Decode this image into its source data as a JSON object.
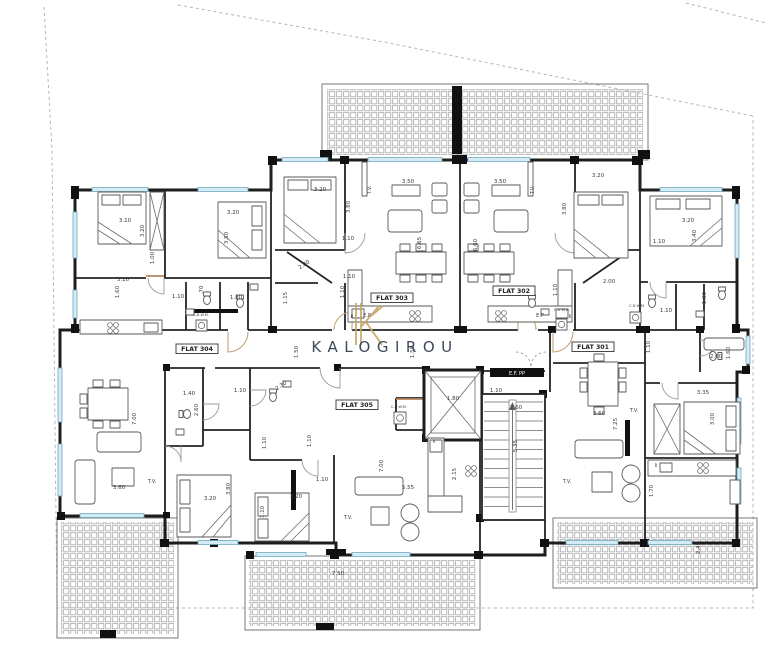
{
  "watermark": {
    "text": "KALOGIROU",
    "color": "#3d4a5c",
    "monogram": "K",
    "monogram_color": "#c5a366"
  },
  "flat_labels": [
    {
      "t": "FLAT 301",
      "x": 593,
      "y": 349
    },
    {
      "t": "FLAT 302",
      "x": 514,
      "y": 293
    },
    {
      "t": "FLAT 303",
      "x": 392,
      "y": 300
    },
    {
      "t": "FLAT 304",
      "x": 197,
      "y": 351
    },
    {
      "t": "FLAT 305",
      "x": 357,
      "y": 407
    }
  ],
  "annotations": [
    {
      "t": "T.V.",
      "x": 371,
      "y": 190,
      "r": -90
    },
    {
      "t": "T.V.",
      "x": 534,
      "y": 190,
      "r": -90
    },
    {
      "t": "T.V.",
      "x": 152,
      "y": 483
    },
    {
      "t": "T.V.",
      "x": 348,
      "y": 519
    },
    {
      "t": "T.V.",
      "x": 567,
      "y": 483
    },
    {
      "t": "T.V.",
      "x": 634,
      "y": 412
    },
    {
      "t": "E.P",
      "x": 367,
      "y": 317
    },
    {
      "t": "E.P",
      "x": 540,
      "y": 317
    },
    {
      "t": "E.F. PP",
      "x": 517,
      "y": 375,
      "s": 5,
      "c": "#ffffff"
    },
    {
      "t": "C.D W.M.",
      "x": 201,
      "y": 316,
      "s": 3.6
    },
    {
      "t": "C.D W.M.",
      "x": 399,
      "y": 408,
      "s": 3.6
    },
    {
      "t": "C.D W.M.",
      "x": 562,
      "y": 311,
      "s": 3.6
    },
    {
      "t": "C.D W.M.",
      "x": 637,
      "y": 307,
      "s": 3.6
    },
    {
      "t": "R",
      "x": 352,
      "y": 318,
      "s": 4
    },
    {
      "t": "R",
      "x": 570,
      "y": 318,
      "s": 4
    },
    {
      "t": "R",
      "x": 434,
      "y": 443,
      "s": 4
    },
    {
      "t": "R",
      "x": 656,
      "y": 467,
      "s": 4
    }
  ],
  "dimensions": [
    {
      "t": "3.10",
      "x": 125,
      "y": 222
    },
    {
      "t": "3.20",
      "x": 144,
      "y": 231,
      "r": -90
    },
    {
      "t": "3.20",
      "x": 233,
      "y": 214
    },
    {
      "t": "3.50",
      "x": 228,
      "y": 238,
      "r": -90
    },
    {
      "t": "1.00",
      "x": 154,
      "y": 258,
      "r": -90
    },
    {
      "t": "3.10",
      "x": 123,
      "y": 281
    },
    {
      "t": "1.60",
      "x": 119,
      "y": 292,
      "r": -90
    },
    {
      "t": "1.10",
      "x": 178,
      "y": 298
    },
    {
      "t": ".70",
      "x": 203,
      "y": 290,
      "r": -90
    },
    {
      "t": "1.80",
      "x": 236,
      "y": 299
    },
    {
      "t": "1.15",
      "x": 287,
      "y": 298,
      "r": -90
    },
    {
      "t": "3.20",
      "x": 320,
      "y": 191
    },
    {
      "t": "3.80",
      "x": 350,
      "y": 207,
      "r": -90
    },
    {
      "t": "1.10",
      "x": 348,
      "y": 240
    },
    {
      "t": "2.00",
      "x": 305,
      "y": 266,
      "r": -34
    },
    {
      "t": "1.10",
      "x": 349,
      "y": 278
    },
    {
      "t": "1.10",
      "x": 344,
      "y": 292,
      "r": -90
    },
    {
      "t": "3.50",
      "x": 408,
      "y": 183
    },
    {
      "t": "6.65",
      "x": 421,
      "y": 243,
      "r": -90
    },
    {
      "t": "3.50",
      "x": 500,
      "y": 183
    },
    {
      "t": "6.60",
      "x": 477,
      "y": 245,
      "r": -90
    },
    {
      "t": "3.20",
      "x": 598,
      "y": 177
    },
    {
      "t": "3.80",
      "x": 566,
      "y": 209,
      "r": -90
    },
    {
      "t": "1.10",
      "x": 659,
      "y": 243
    },
    {
      "t": "2.00",
      "x": 609,
      "y": 283
    },
    {
      "t": "1.10",
      "x": 557,
      "y": 290,
      "r": -90
    },
    {
      "t": "3.20",
      "x": 688,
      "y": 222
    },
    {
      "t": "3.40",
      "x": 696,
      "y": 236,
      "r": -90
    },
    {
      "t": "1.90",
      "x": 706,
      "y": 298,
      "r": -90
    },
    {
      "t": "1.10",
      "x": 666,
      "y": 312
    },
    {
      "t": "2.60",
      "x": 716,
      "y": 358
    },
    {
      "t": "1.60",
      "x": 730,
      "y": 353,
      "r": -90
    },
    {
      "t": "1.50",
      "x": 298,
      "y": 352,
      "r": -90
    },
    {
      "t": "1.50",
      "x": 414,
      "y": 352,
      "r": -90
    },
    {
      "t": "1.10",
      "x": 650,
      "y": 347,
      "r": -90
    },
    {
      "t": "1.80",
      "x": 453,
      "y": 400
    },
    {
      "t": "1.10",
      "x": 496,
      "y": 392
    },
    {
      "t": "2.60",
      "x": 516,
      "y": 409
    },
    {
      "t": "5.35",
      "x": 517,
      "y": 446,
      "r": -90
    },
    {
      "t": "1.40",
      "x": 189,
      "y": 395
    },
    {
      "t": "2.60",
      "x": 198,
      "y": 410,
      "r": -90
    },
    {
      "t": "7.00",
      "x": 136,
      "y": 419,
      "r": -90
    },
    {
      "t": "3.60",
      "x": 119,
      "y": 489
    },
    {
      "t": "3.20",
      "x": 210,
      "y": 500
    },
    {
      "t": "3.80",
      "x": 230,
      "y": 489,
      "r": -90
    },
    {
      "t": "1.10",
      "x": 240,
      "y": 392
    },
    {
      "t": "2.30",
      "x": 282,
      "y": 387,
      "r": -34
    },
    {
      "t": "1.10",
      "x": 266,
      "y": 443,
      "r": -90
    },
    {
      "t": "1.10",
      "x": 311,
      "y": 441,
      "r": -90
    },
    {
      "t": "1.10",
      "x": 322,
      "y": 481
    },
    {
      "t": "3.20",
      "x": 296,
      "y": 498
    },
    {
      "t": "1.10",
      "x": 264,
      "y": 512,
      "r": -90
    },
    {
      "t": "7.00",
      "x": 383,
      "y": 466,
      "r": -90
    },
    {
      "t": "2.15",
      "x": 456,
      "y": 474,
      "r": -90
    },
    {
      "t": "5.55",
      "x": 408,
      "y": 489
    },
    {
      "t": "7.50",
      "x": 338,
      "y": 575
    },
    {
      "t": "3.60",
      "x": 599,
      "y": 415
    },
    {
      "t": "7.25",
      "x": 617,
      "y": 424,
      "r": -90
    },
    {
      "t": "3.35",
      "x": 703,
      "y": 394
    },
    {
      "t": "3.00",
      "x": 714,
      "y": 419,
      "r": -90
    },
    {
      "t": "1.70",
      "x": 653,
      "y": 491,
      "r": -90
    },
    {
      "t": "2.45",
      "x": 700,
      "y": 548,
      "r": -90
    }
  ],
  "colors": {
    "wall": "#1d1d1d",
    "window": "#d6ecf5",
    "hatch": "#b3b3b3",
    "dimension_text": "#3a3a3a"
  }
}
